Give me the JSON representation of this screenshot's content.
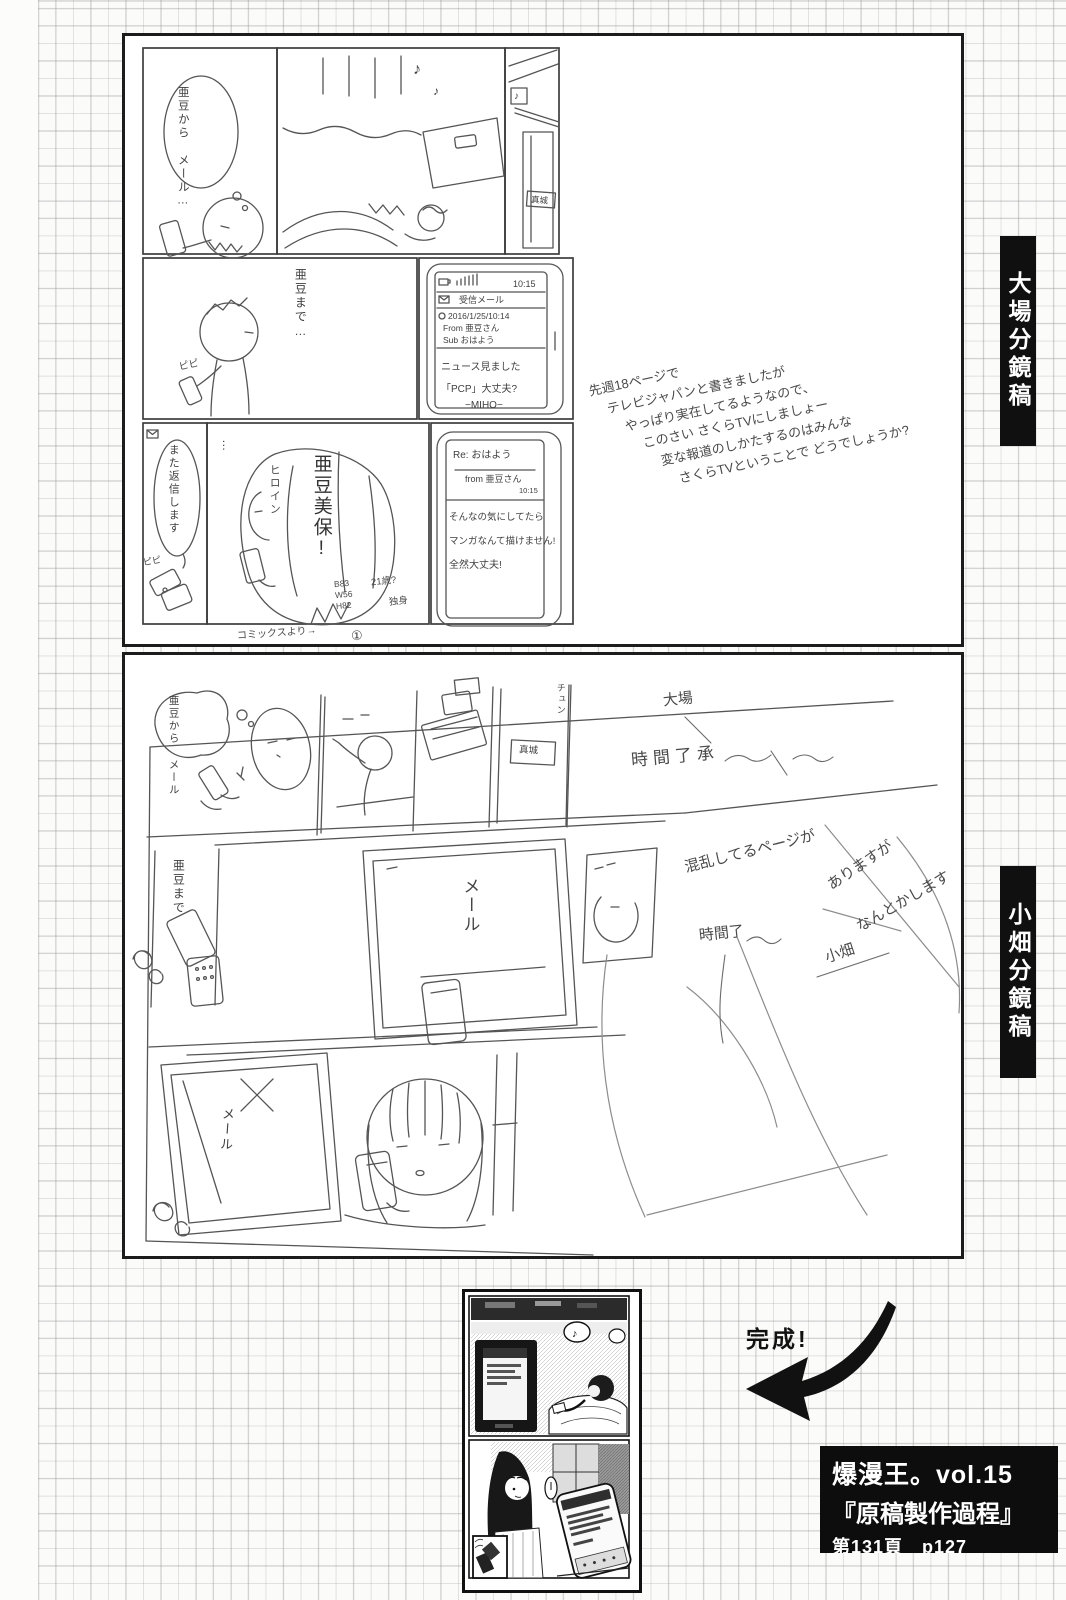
{
  "labels": {
    "ohba": "大場分鏡稿",
    "obata": "小畑分鏡稿"
  },
  "sfx": {
    "note": "♪",
    "pipi": "ピピ",
    "chirp": "チュン",
    "dots": "…"
  },
  "page1": {
    "bubble_from_1": "亜豆から",
    "bubble_from_2": "メール…",
    "bubble_to": "亜豆まで…",
    "nameplate": "真城",
    "phone_mail": {
      "time": "10:15",
      "title": "受信メール",
      "date": "2016/1/25/10:14",
      "from": "From 亜豆さん",
      "sub": "Sub おはよう",
      "body1": "ニュース見ました",
      "body2": "「PCP」大丈夫?",
      "sign": "−MIHO−"
    },
    "bubble_reply": "また返信します",
    "heroine_role": "ヒロイン",
    "heroine_name": "亜豆美保!",
    "stat_b": "B83",
    "stat_w": "W56",
    "stat_h": "H82",
    "stat_age": "21歳?",
    "stat_single": "独身",
    "phone_reply": {
      "subject": "Re: おはよう",
      "from": "from 亜豆さん",
      "time": "10:15",
      "line1": "そんなの気にしてたら",
      "line2": "マンガなんて描けません!",
      "line3": "全然大丈夫!"
    },
    "handnote": [
      "先週18ページで",
      "テレビジャパンと書きましたが",
      "やっぱり実在してるようなので、",
      "このさい さくらTVにしましょー",
      "変な報道のしかたするのはみんな",
      "さくらTVということで どうでしょうか?"
    ],
    "footer_note": "コミックスより→",
    "page_num": "①"
  },
  "page2": {
    "bubble_from_1": "亜豆から",
    "bubble_from_2": "メール",
    "label_to": "亜豆まで",
    "mail_big": "メール",
    "mail_small": "メール",
    "nameplate": "真城",
    "note_name": "大場",
    "note_time": "時間了承",
    "note_line1": "混乱してるページが",
    "note_line2": "ありますが",
    "note_line3": "なんとかします",
    "note_time2": "時間了",
    "signature": "小畑"
  },
  "finished": {
    "caption": "完成!"
  },
  "info_box": {
    "line1": "爆漫王。vol.15",
    "line2": "『原稿製作過程』",
    "line3": "第131頁　p127"
  },
  "colors": {
    "paper": "#fbfbfa",
    "grid": "#919191",
    "ink": "#111111",
    "pencil": "#555555"
  }
}
